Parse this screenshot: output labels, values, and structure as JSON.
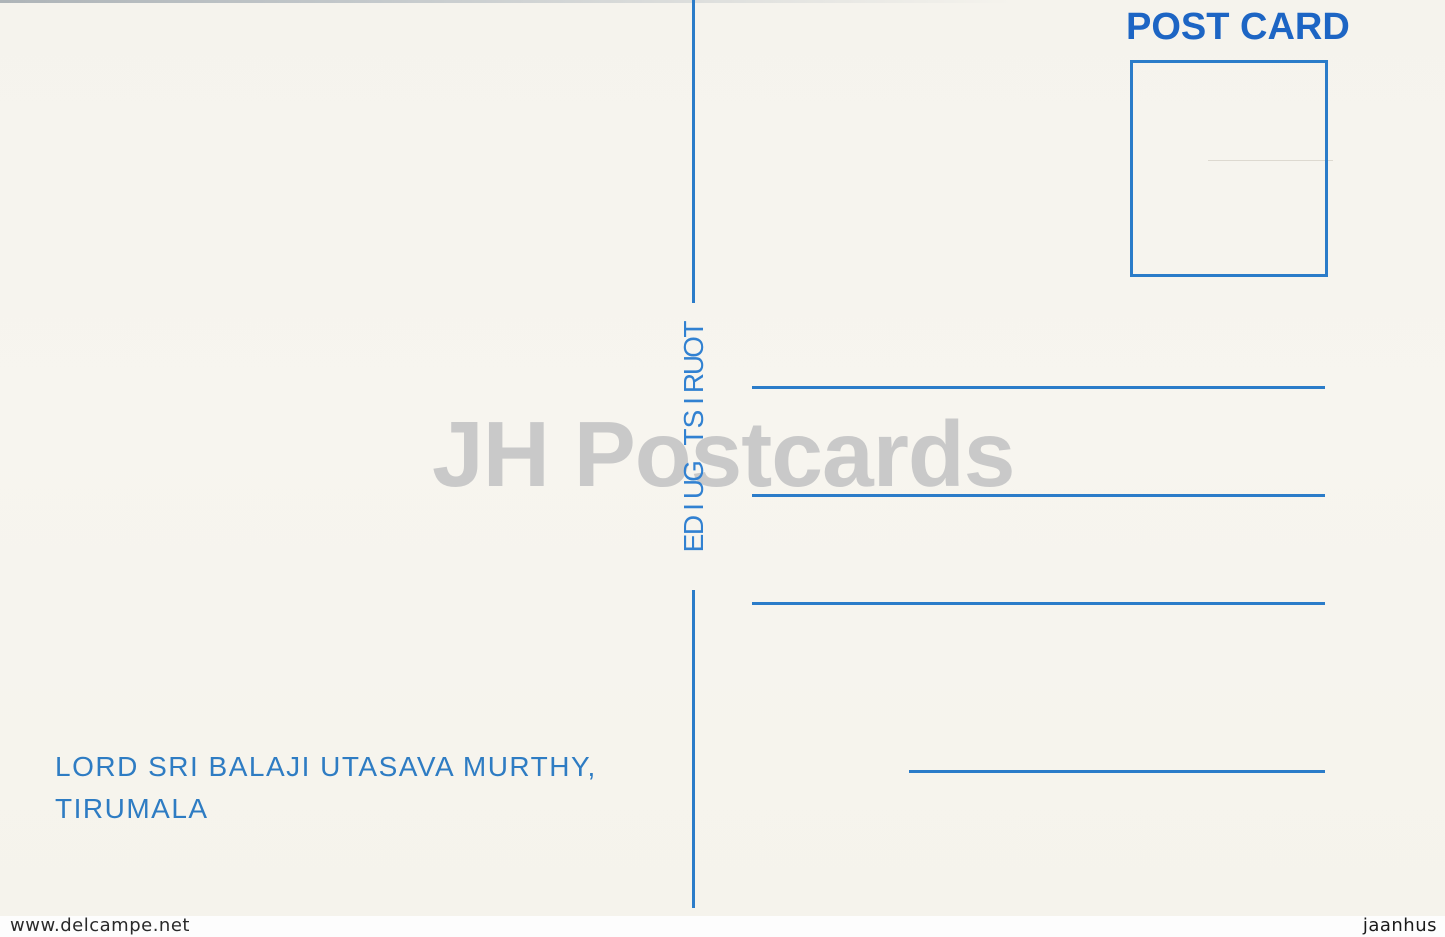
{
  "postcard": {
    "title": "POST CARD",
    "divider_label": "TOURIST GUIDE",
    "divider_letters": [
      "T",
      "O",
      "U",
      "R",
      "I",
      "S",
      "T",
      "G",
      "U",
      "I",
      "D",
      "E"
    ],
    "caption": {
      "line1": "LORD SRI BALAJI UTASAVA MURTHY,",
      "line2": "TIRUMALA"
    },
    "watermark": "JH Postcards",
    "address_line_count": 4
  },
  "footer": {
    "left_text": "www.delcampe.net",
    "right_text": "jaanhus"
  },
  "colors": {
    "ink_blue": "#2b7cc9",
    "ink_blue_bold": "#1d65c4",
    "ink_blue_light": "#3181d1",
    "paper_cream": "#f6f4ee",
    "watermark_gray": "#c9c9c9",
    "footer_strip_white": "#fdfdfd",
    "footer_text": "#1f1f1f"
  }
}
